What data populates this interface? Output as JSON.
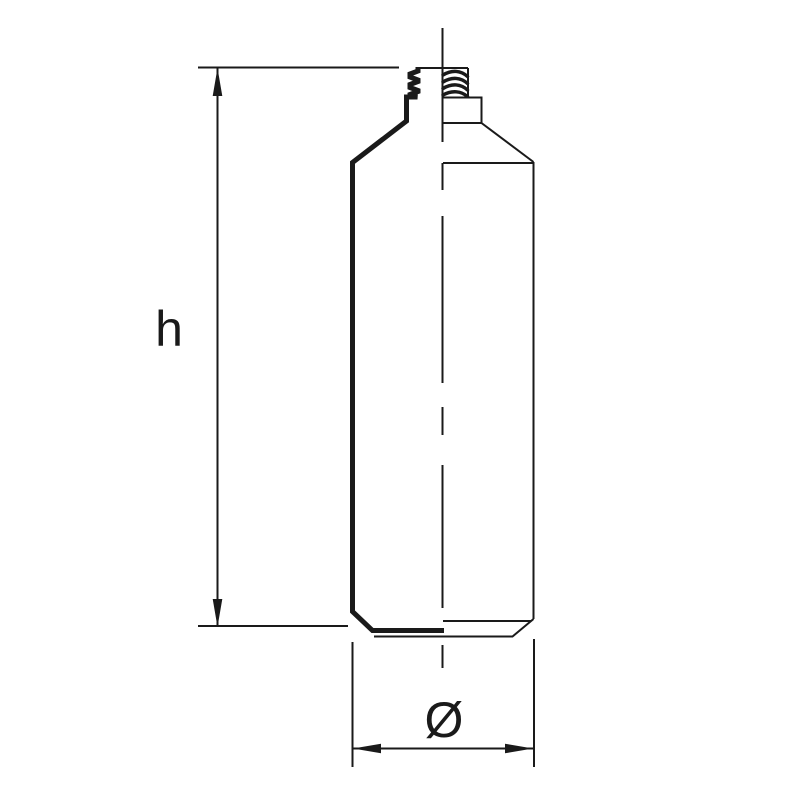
{
  "drawing": {
    "type": "bottle-technical-drawing",
    "labels": {
      "height": "h",
      "diameter": "Ø"
    },
    "colors": {
      "line": "#1a1a1a",
      "background": "#ffffff"
    }
  }
}
